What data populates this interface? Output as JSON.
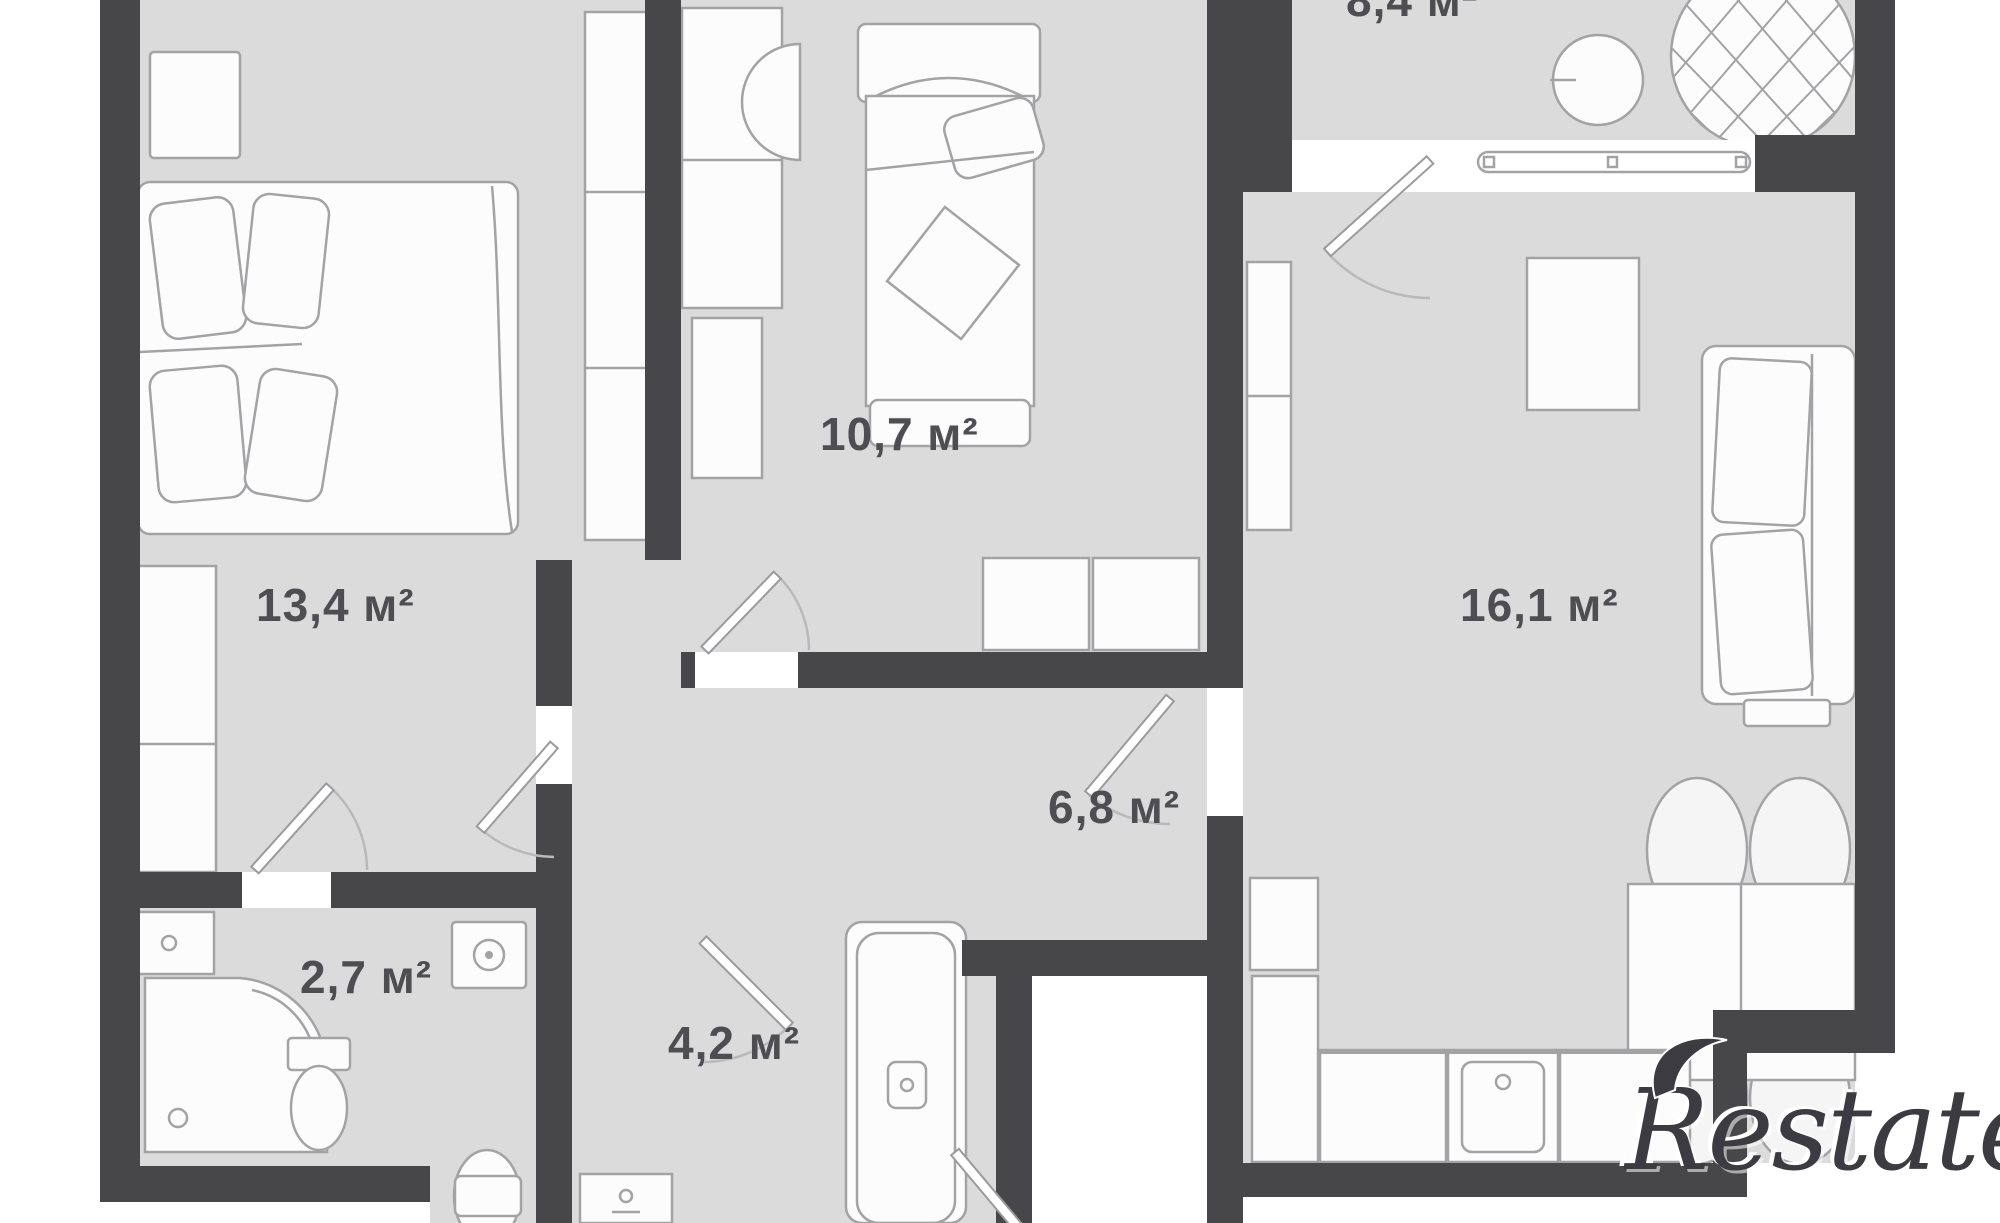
{
  "floor_plan": {
    "watermark_text": "Restate",
    "rooms": [
      {
        "id": "room-top-cut",
        "area": "8,4 м²"
      },
      {
        "id": "bedroom-large",
        "area": "13,4 м²"
      },
      {
        "id": "bedroom-small",
        "area": "10,7 м²"
      },
      {
        "id": "living-kitchen",
        "area": "16,1 м²"
      },
      {
        "id": "hallway",
        "area": "6,8 м²"
      },
      {
        "id": "shower-room",
        "area": "2,7 м²"
      },
      {
        "id": "bathroom",
        "area": "4,2 м²"
      }
    ],
    "colors": {
      "wall": "#47474a",
      "floor": "#dbdbdc",
      "furniture_fill": "#fcfcfc",
      "furniture_stroke": "#a3a3a6",
      "label_text": "#4e4e52",
      "watermark_text_color": "#3b3b41"
    }
  }
}
